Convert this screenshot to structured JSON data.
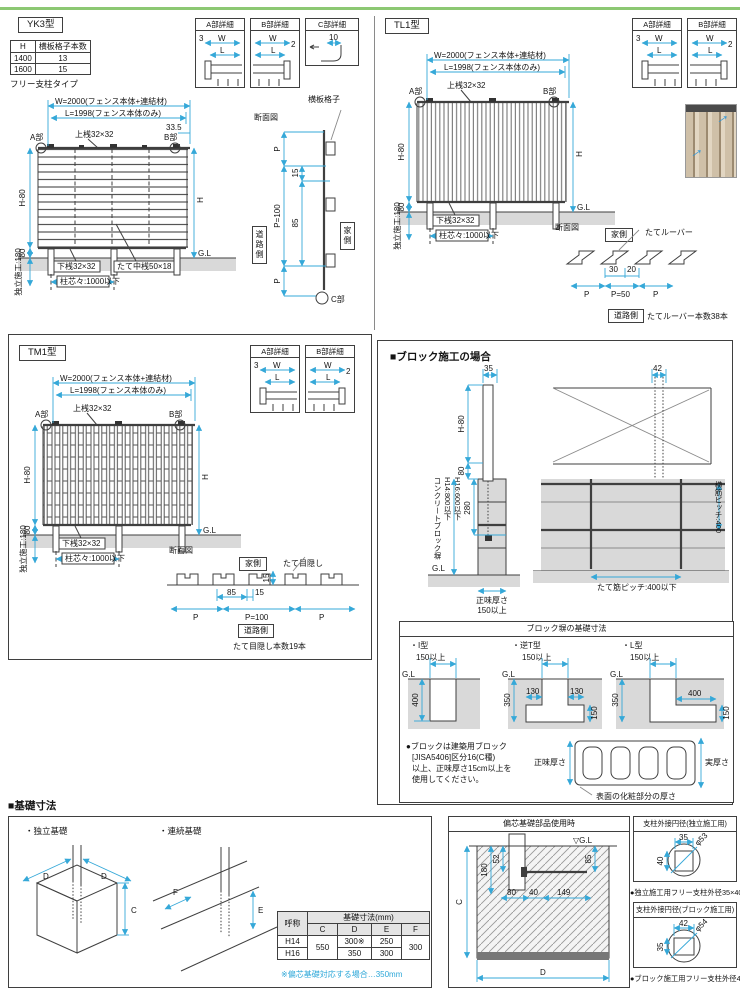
{
  "page": {
    "accent_green": "#8cc873",
    "dim_color": "#35a8d8"
  },
  "yk3": {
    "title": "YK3型",
    "spec_table": {
      "col_h": "H",
      "col_n": "横板格子本数",
      "rows": [
        [
          "1400",
          "13"
        ],
        [
          "1600",
          "15"
        ]
      ]
    },
    "type_label": "フリー支柱タイプ",
    "front": {
      "dim_w": "W=2000(フェンス本体+連結材)",
      "dim_l": "L=1998(フェンス本体のみ)",
      "dim_335": "33.5",
      "part_a": "A部",
      "part_b": "B部",
      "top_rail": "上桟32×32",
      "dim_h80": "H-80",
      "dim_80": "80",
      "dim_h": "H",
      "gl": "G.L",
      "bottom_rail": "下桟32×32",
      "mid_rail": "たて中桟50×18",
      "post_pitch": "柱芯々:1000以下",
      "install": "独立施工:180"
    },
    "detail_a": {
      "title": "A部詳細",
      "d3": "3",
      "dw": "W",
      "dl": "L"
    },
    "detail_b": {
      "title": "B部詳細",
      "dw": "W",
      "dl": "L",
      "d2": "2"
    },
    "detail_c": {
      "title": "C部詳細",
      "d10": "10"
    },
    "section": {
      "title": "断面図",
      "p_top": "P",
      "p_mid": "P=100",
      "p_bot": "P",
      "d15": "15",
      "d85": "85",
      "board": "横板格子",
      "road": "道路側",
      "house": "家側",
      "part_c": "C部"
    }
  },
  "tl1": {
    "title": "TL1型",
    "front": {
      "dim_w": "W=2000(フェンス本体+連結材)",
      "dim_l": "L=1998(フェンス本体のみ)",
      "part_a": "A部",
      "part_b": "B部",
      "top_rail": "上桟32×32",
      "dim_h80": "H-80",
      "dim_80": "80",
      "dim_h": "H",
      "gl": "G.L",
      "bottom_rail": "下桟32×32",
      "post_pitch": "柱芯々:1000以下",
      "install": "独立施工:180"
    },
    "detail_a": {
      "title": "A部詳細",
      "d3": "3",
      "dw": "W",
      "dl": "L"
    },
    "detail_b": {
      "title": "B部詳細",
      "dw": "W",
      "dl": "L",
      "d2": "2"
    },
    "section": {
      "title": "断面図",
      "house": "家側",
      "louver": "たてルーバー",
      "d30": "30",
      "d20": "20",
      "p_l": "P",
      "p_mid": "P=50",
      "p_r": "P",
      "road": "道路側",
      "count": "たてルーバー本数38本"
    }
  },
  "tm1": {
    "title": "TM1型",
    "front": {
      "dim_w": "W=2000(フェンス本体+連結材)",
      "dim_l": "L=1998(フェンス本体のみ)",
      "part_a": "A部",
      "part_b": "B部",
      "top_rail": "上桟32×32",
      "dim_h80": "H-80",
      "dim_80": "80",
      "dim_h": "H",
      "gl": "G.L",
      "bottom_rail": "下桟32×32",
      "post_pitch": "柱芯々:1000以下",
      "install": "独立施工:180"
    },
    "detail_a": {
      "title": "A部詳細",
      "d3": "3",
      "dw": "W",
      "dl": "L"
    },
    "detail_b": {
      "title": "B部詳細",
      "dw": "W",
      "dl": "L",
      "d2": "2"
    },
    "section": {
      "title": "断面図",
      "house": "家側",
      "slat": "たて目隠し",
      "d15": "15",
      "d85": "85",
      "d15b": "15",
      "p_l": "P",
      "p_mid": "P=100",
      "p_r": "P",
      "road": "道路側",
      "count": "たて目隠し本数19本"
    }
  },
  "block": {
    "title": "■ブロック施工の場合",
    "side": {
      "d35": "35",
      "dim_h80": "H-80",
      "d80": "80",
      "d280": "280",
      "wall_l1": "コンクリートブロック塀",
      "wall_l2": "H14:800以下",
      "wall_l3": "H16:600以下",
      "gl": "G.L",
      "net1": "正味厚さ",
      "net2": "150以上"
    },
    "front": {
      "d42": "42",
      "yoko": "横筋ピッチ:400",
      "tate": "たて筋ピッチ:400以下"
    },
    "foundation": {
      "title": "ブロック塀の基礎寸法",
      "i_label": "・I型",
      "i_w": "150以上",
      "i_gl": "G.L",
      "i_d": "400",
      "t_label": "・逆T型",
      "t_w": "150以上",
      "t_gl": "G.L",
      "t_130l": "130",
      "t_130r": "130",
      "t_350": "350",
      "t_150": "150",
      "l_label": "・L型",
      "l_w": "150以上",
      "l_gl": "G.L",
      "l_400": "400",
      "l_350": "350",
      "l_150": "150",
      "note_l1": "●ブロックは建築用ブロック",
      "note_l2": "[JISA5406]区分16(C種)",
      "note_l3": "以上、正味厚さ15cm以上を",
      "note_l4": "使用してください。",
      "net": "正味厚さ",
      "actual": "実厚さ",
      "surface": "表面の化粧部分の厚さ"
    }
  },
  "base": {
    "title": "■基礎寸法",
    "indep_label": "・独立基礎",
    "d1": "D",
    "d2": "D",
    "c": "C",
    "cont_label": "・連続基礎",
    "f": "F",
    "e": "E",
    "table": {
      "name_h": "呼称",
      "dim_h": "基礎寸法(mm)",
      "c": "C",
      "d": "D",
      "e": "E",
      "f": "F",
      "row1": "H14",
      "row2": "H16",
      "c_val": "550",
      "d1": "300※",
      "e1": "250",
      "d2": "350",
      "e2": "300",
      "f_val": "300"
    },
    "note": "※偏芯基礎対応する場合…350mm"
  },
  "ecc": {
    "title": "偏芯基礎部品使用時",
    "gl": "▽G.L",
    "d85": "85",
    "d52": "52",
    "d180": "180",
    "c": "C",
    "d80": "80",
    "d40": "40",
    "d149": "149",
    "d": "D"
  },
  "circ1": {
    "title": "支柱外接円径(独立施工用)",
    "top": "35",
    "left": "40",
    "dia": "φ53",
    "note": "●独立施工用フリー支柱外径35×40"
  },
  "circ2": {
    "title": "支柱外接円径(ブロック施工用)",
    "top": "42",
    "left": "35",
    "dia": "φ54",
    "note": "●ブロック施工用フリー支柱外径42×35"
  }
}
